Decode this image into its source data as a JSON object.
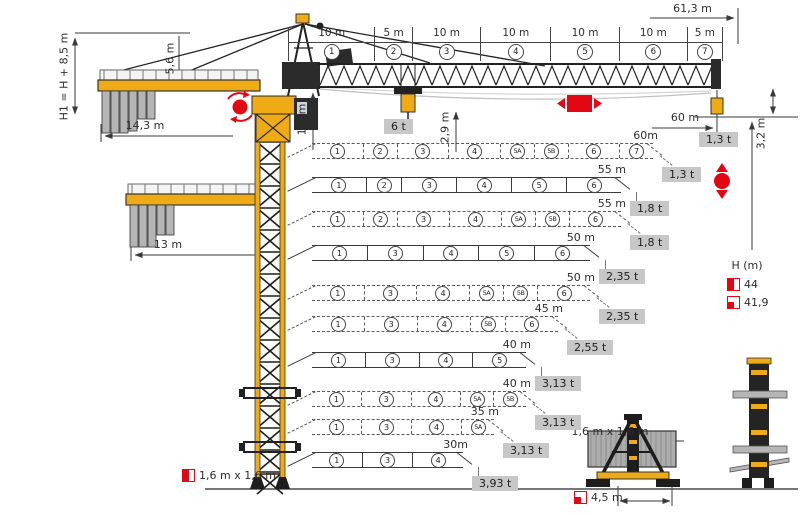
{
  "colors": {
    "crane_yellow": "#eeab15",
    "red": "#e30613",
    "gray_box": "#c7c7c7",
    "ballast_gray": "#b5b5b5",
    "line": "#3a3a3a"
  },
  "dimensions": {
    "overall_jib": "61,3 m",
    "height_note": "H1 = H + 8,5 m",
    "apex_height": "5,6 m",
    "counterjib_long": "14,3 m",
    "counterjib_short": "13 m",
    "jib_depth": "1,3 m",
    "hook_drop": "2,9 m",
    "tip_height": "3,2 m",
    "tip_radius": "60 m",
    "mast_width_left": "1,6 m x 1,6 m",
    "mast_width_base": "1,6 m x 1,6 m",
    "base_track": "4,5 m"
  },
  "loads": {
    "max_load": "6 t",
    "tip_load": "1,3 t"
  },
  "jib_dim_sections": [
    {
      "label": "10 m",
      "num": "1"
    },
    {
      "label": "5 m",
      "num": "2"
    },
    {
      "label": "10 m",
      "num": "3"
    },
    {
      "label": "10 m",
      "num": "4"
    },
    {
      "label": "10 m",
      "num": "5"
    },
    {
      "label": "10 m",
      "num": "6"
    },
    {
      "label": "5 m",
      "num": "7"
    }
  ],
  "rows": [
    {
      "length_label": "60m",
      "capacity": "1,3 t",
      "style": "dashed",
      "length_m": 60,
      "sections": [
        {
          "id": "1",
          "m": 10
        },
        {
          "id": "2",
          "m": 5
        },
        {
          "id": "3",
          "m": 10
        },
        {
          "id": "4",
          "m": 10
        },
        {
          "id": "5A",
          "m": 5
        },
        {
          "id": "5B",
          "m": 5
        },
        {
          "id": "6",
          "m": 10
        },
        {
          "id": "7",
          "m": 5
        }
      ]
    },
    {
      "length_label": "55 m",
      "capacity": "1,8 t",
      "style": "solid",
      "length_m": 55,
      "sections": [
        {
          "id": "1",
          "m": 10
        },
        {
          "id": "2",
          "m": 5
        },
        {
          "id": "3",
          "m": 10
        },
        {
          "id": "4",
          "m": 10
        },
        {
          "id": "5",
          "m": 10
        },
        {
          "id": "6",
          "m": 10
        }
      ]
    },
    {
      "length_label": "55 m",
      "capacity": "1,8 t",
      "style": "dashed",
      "length_m": 55,
      "sections": [
        {
          "id": "1",
          "m": 10
        },
        {
          "id": "2",
          "m": 5
        },
        {
          "id": "3",
          "m": 10
        },
        {
          "id": "4",
          "m": 10
        },
        {
          "id": "5A",
          "m": 5
        },
        {
          "id": "5B",
          "m": 5
        },
        {
          "id": "6",
          "m": 10
        }
      ]
    },
    {
      "length_label": "50 m",
      "capacity": "2,35 t",
      "style": "solid",
      "length_m": 50,
      "sections": [
        {
          "id": "1",
          "m": 10
        },
        {
          "id": "3",
          "m": 10
        },
        {
          "id": "4",
          "m": 10
        },
        {
          "id": "5",
          "m": 10
        },
        {
          "id": "6",
          "m": 10
        }
      ]
    },
    {
      "length_label": "50 m",
      "capacity": "2,35 t",
      "style": "dashed",
      "length_m": 50,
      "sections": [
        {
          "id": "1",
          "m": 10
        },
        {
          "id": "3",
          "m": 10
        },
        {
          "id": "4",
          "m": 10
        },
        {
          "id": "5A",
          "m": 5
        },
        {
          "id": "5B",
          "m": 5
        },
        {
          "id": "6",
          "m": 10
        }
      ]
    },
    {
      "length_label": "45 m",
      "capacity": "2,55 t",
      "style": "dashed",
      "length_m": 45,
      "sections": [
        {
          "id": "1",
          "m": 10
        },
        {
          "id": "3",
          "m": 10
        },
        {
          "id": "4",
          "m": 10
        },
        {
          "id": "5B",
          "m": 5
        },
        {
          "id": "6",
          "m": 10
        }
      ]
    },
    {
      "length_label": "40 m",
      "capacity": "3,13 t",
      "style": "solid",
      "length_m": 40,
      "sections": [
        {
          "id": "1",
          "m": 10
        },
        {
          "id": "3",
          "m": 10
        },
        {
          "id": "4",
          "m": 10
        },
        {
          "id": "5",
          "m": 10
        }
      ]
    },
    {
      "length_label": "40 m",
      "capacity": "3,13 t",
      "style": "dashed",
      "length_m": 40,
      "sections": [
        {
          "id": "1",
          "m": 10
        },
        {
          "id": "3",
          "m": 10
        },
        {
          "id": "4",
          "m": 10
        },
        {
          "id": "5A",
          "m": 5
        },
        {
          "id": "5B",
          "m": 5
        }
      ]
    },
    {
      "length_label": "35 m",
      "capacity": "3,13 t",
      "style": "dashed",
      "length_m": 35,
      "sections": [
        {
          "id": "1",
          "m": 10
        },
        {
          "id": "3",
          "m": 10
        },
        {
          "id": "4",
          "m": 10
        },
        {
          "id": "5A",
          "m": 5
        }
      ]
    },
    {
      "length_label": "30m",
      "capacity": "3,93 t",
      "style": "solid",
      "length_m": 30,
      "sections": [
        {
          "id": "1",
          "m": 10
        },
        {
          "id": "3",
          "m": 10
        },
        {
          "id": "4",
          "m": 10
        }
      ]
    }
  ],
  "legend": {
    "title": "H (m)",
    "entries": [
      {
        "icon": "half-red-square-icon",
        "value": "44"
      },
      {
        "icon": "corner-red-square-icon",
        "value": "41,9"
      }
    ]
  },
  "symbols": {
    "slewing": "slewing-rotation-icon",
    "trolley": "trolley-travel-icon",
    "hoist": "hoist-icon"
  }
}
